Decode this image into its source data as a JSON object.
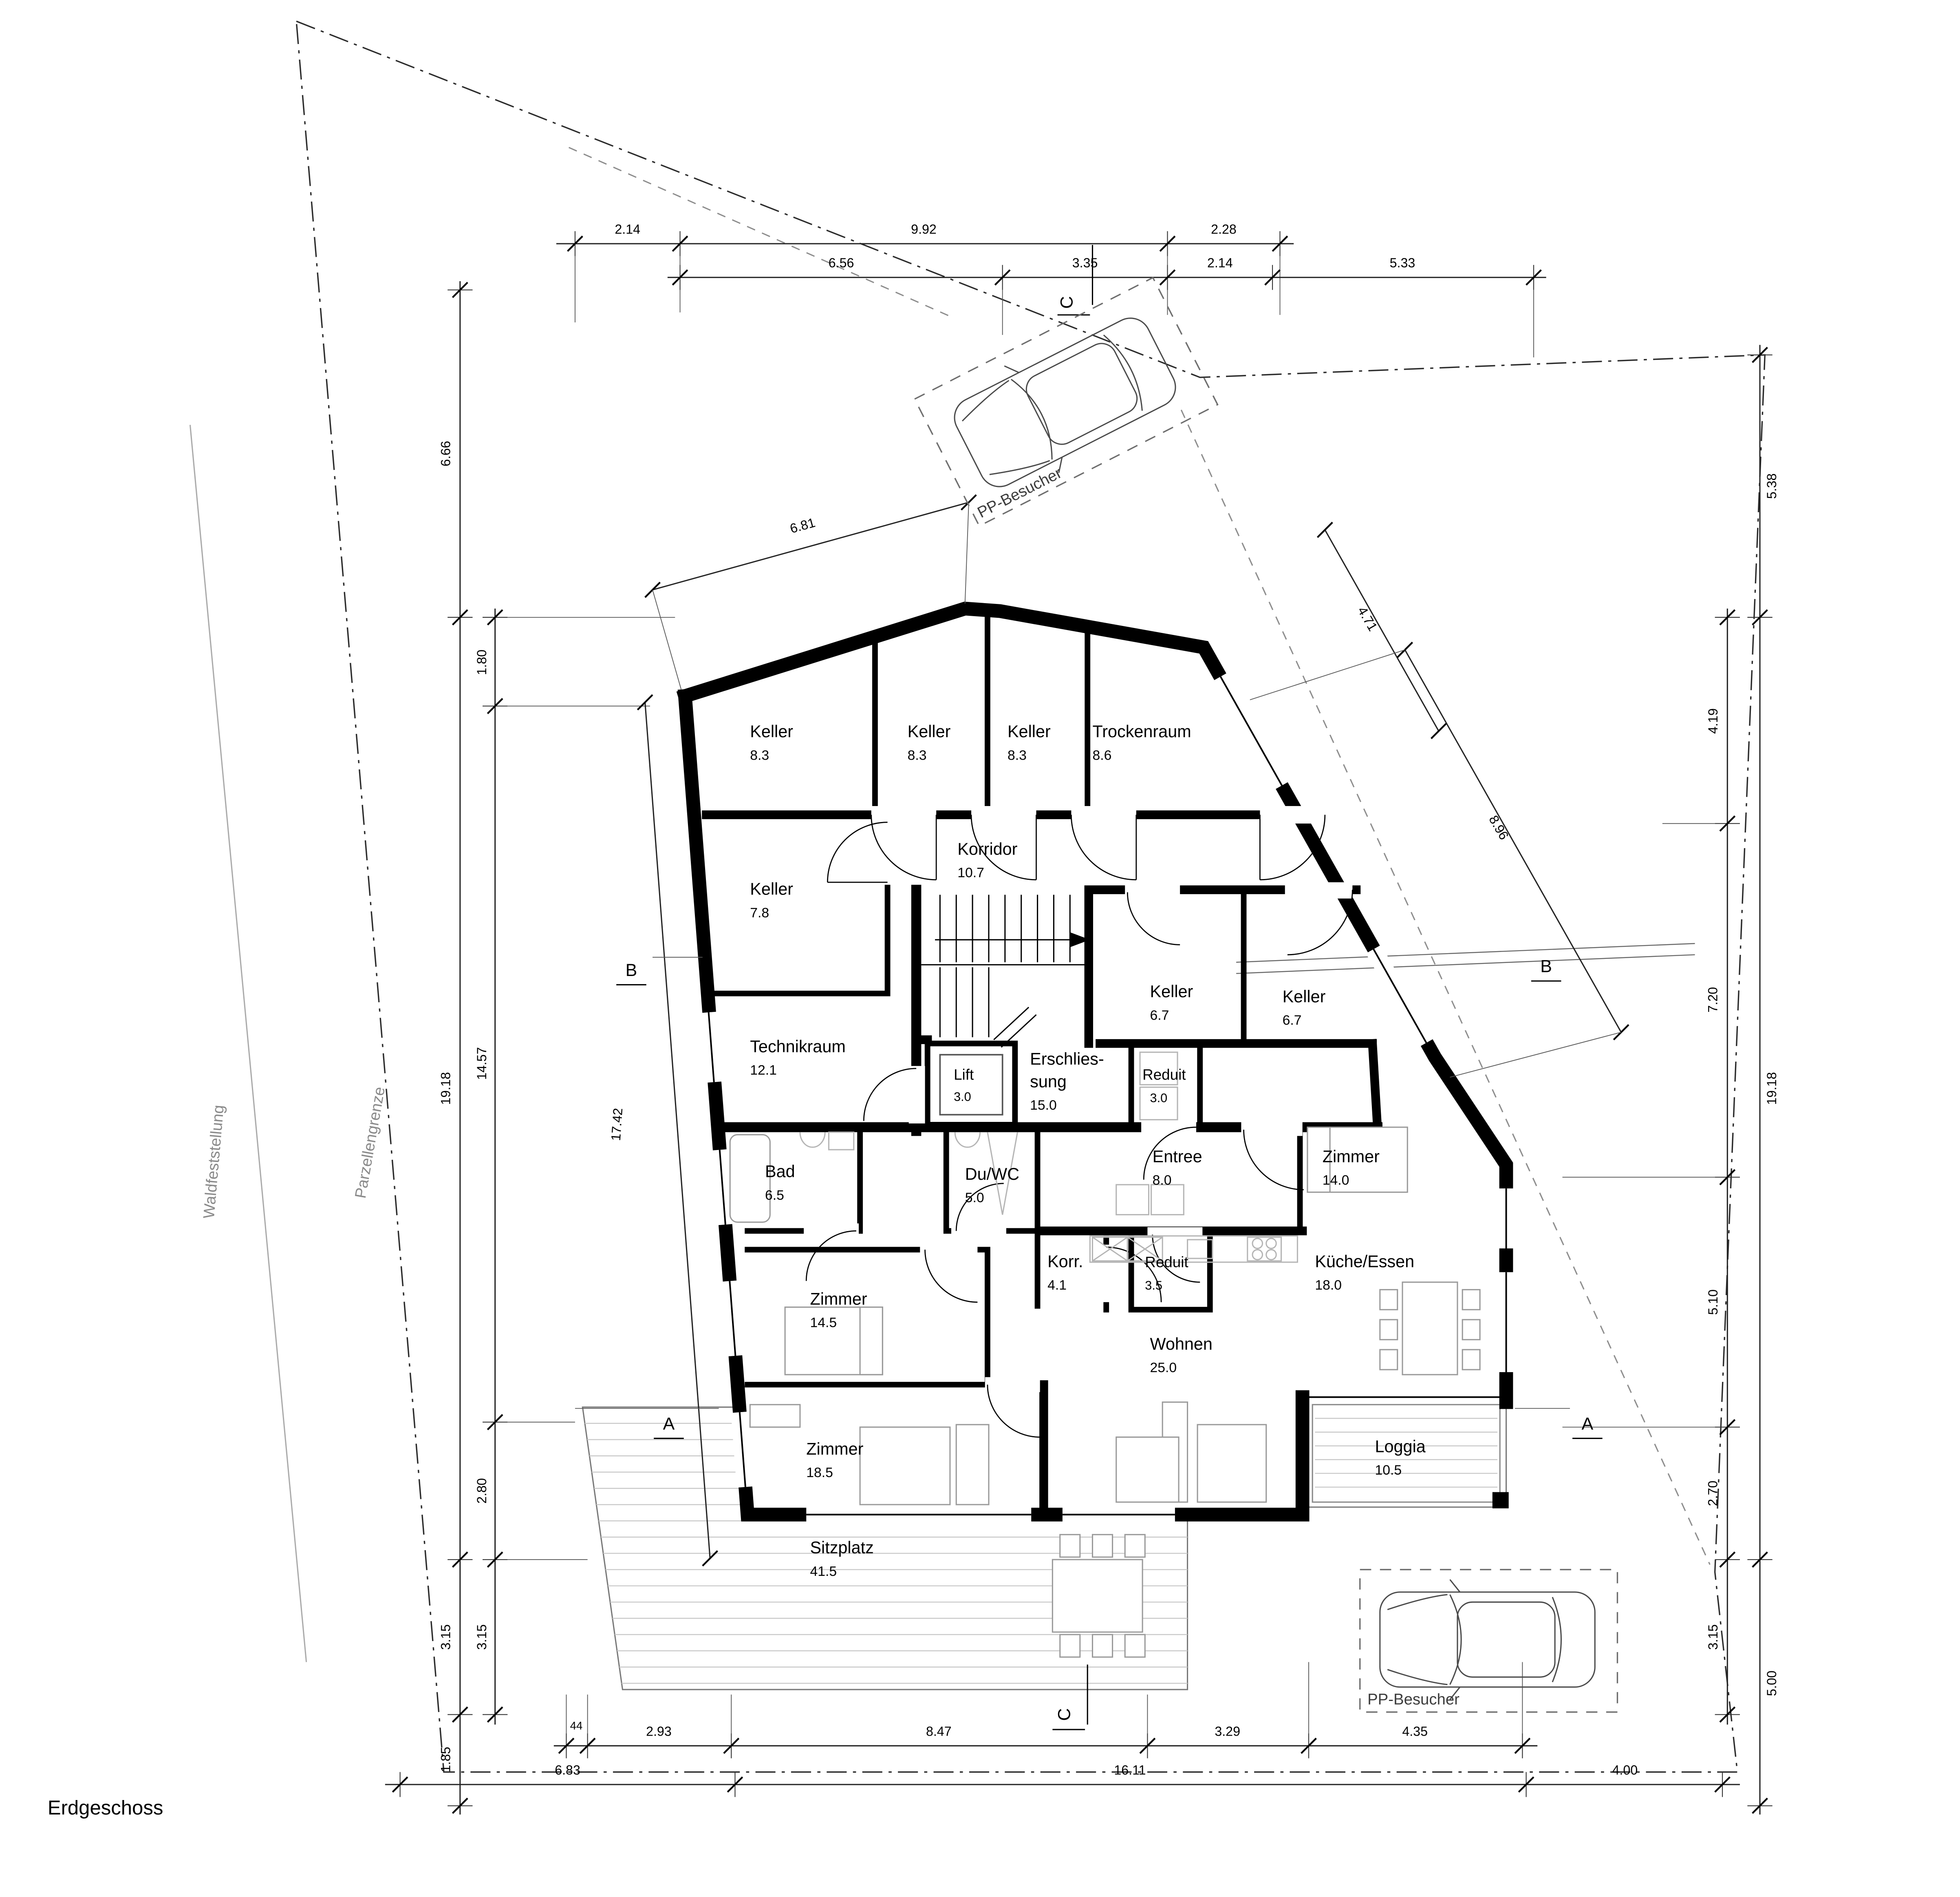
{
  "plan": {
    "title": "Erdgeschoss"
  },
  "site": {
    "forest_label": "Waldfeststellung",
    "boundary_label": "Parzellengrenze"
  },
  "parking": {
    "top_label": "PP-Besucher",
    "bottom_label": "PP-Besucher"
  },
  "markers": {
    "a": "A",
    "b": "B",
    "c": "C"
  },
  "rooms": [
    {
      "name": "Keller",
      "area": "8.3"
    },
    {
      "name": "Keller",
      "area": "8.3"
    },
    {
      "name": "Keller",
      "area": "8.3"
    },
    {
      "name": "Trockenraum",
      "area": "8.6"
    },
    {
      "name": "Korridor",
      "area": "10.7"
    },
    {
      "name": "Keller",
      "area": "7.8"
    },
    {
      "name": "Keller",
      "area": "6.7"
    },
    {
      "name": "Keller",
      "area": "6.7"
    },
    {
      "name": "Technikraum",
      "area": "12.1"
    },
    {
      "name": "Lift",
      "area": "3.0"
    },
    {
      "name": "Erschlies-",
      "name2": "sung",
      "area": "15.0"
    },
    {
      "name": "Reduit",
      "area": "3.0"
    },
    {
      "name": "Bad",
      "area": "6.5"
    },
    {
      "name": "Du/WC",
      "area": "5.0"
    },
    {
      "name": "Entree",
      "area": "8.0"
    },
    {
      "name": "Zimmer",
      "area": "14.0"
    },
    {
      "name": "Korr.",
      "area": "4.1"
    },
    {
      "name": "Reduit",
      "area": "3.5"
    },
    {
      "name": "Küche/Essen",
      "area": "18.0"
    },
    {
      "name": "Zimmer",
      "area": "14.5"
    },
    {
      "name": "Wohnen",
      "area": "25.0"
    },
    {
      "name": "Zimmer",
      "area": "18.5"
    },
    {
      "name": "Loggia",
      "area": "10.5"
    },
    {
      "name": "Sitzplatz",
      "area": "41.5"
    }
  ],
  "dims": {
    "top1": [
      "2.14",
      "9.92",
      "2.28"
    ],
    "top2": [
      "6.56",
      "3.35",
      "2.14",
      "5.33"
    ],
    "top_diag": "6.81",
    "left_outer": [
      "6.66",
      "19.18",
      "3.15",
      "1.85"
    ],
    "left_inner": [
      "1.80",
      "14.57",
      "2.80",
      "3.15"
    ],
    "left_diag": "17.42",
    "right_outer": [
      "5.38",
      "19.18",
      "5.00"
    ],
    "right_inner": [
      "4.19",
      "7.20",
      "5.10",
      "2.70",
      "3.15"
    ],
    "right_diag_short": "4.71",
    "right_diag_long": "8.96",
    "bottom1": [
      "44",
      "2.93",
      "8.47",
      "3.29",
      "4.35"
    ],
    "bottom2": [
      "6.83",
      "16.11",
      "4.00"
    ]
  }
}
